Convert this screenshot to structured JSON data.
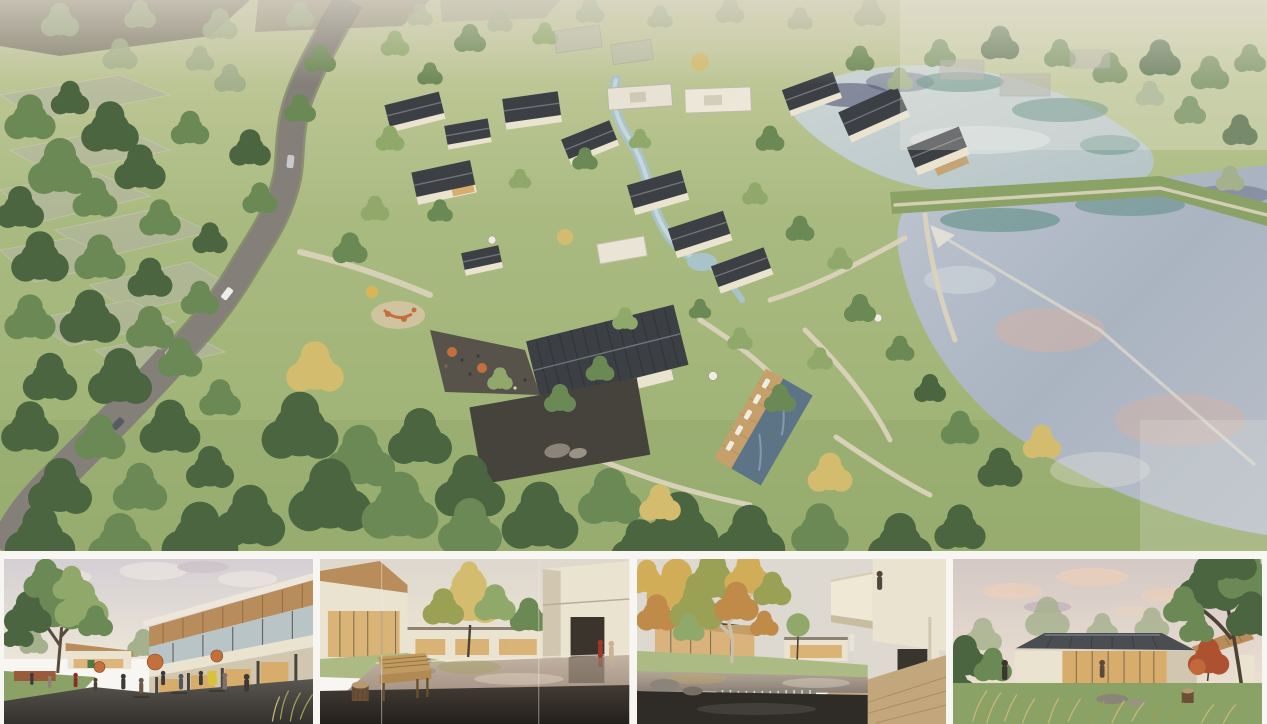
{
  "board": {
    "type": "architectural-rendering-presentation-board",
    "hero": {
      "label": "aerial-masterplan-render",
      "description": "Aerial rendering of a courtyard-house village resort: cream walls and dark pitched roofs clustered among meadows and mature trees, a curving grey access road with cars at left, terraced field plots, a winding stream, a swimming pool with timber deck and loungers, a playground and cafe terrace with orange umbrellas, and two large reflective ponds separated by a grass berm with a spillway at right."
    },
    "thumbnails": [
      {
        "label": "plaza-street-render",
        "description": "Eye-level view of a lively plaza street: two-storey buildings with slanted timber-lined roof canopies, terracotta cafe umbrellas and a small yellow shop sign, many people dining outdoors, a large green tree at left, dark paving foreground, soft pink-grey sky."
      },
      {
        "label": "courtyard-pond-render",
        "description": "Quiet courtyard with a shallow reflecting pond between cream buildings, a golden-green tree at its centre, a honey-wood bench and carved log stool on the dark stone deck in the foreground, and two figures in red and tan coats walking at right."
      },
      {
        "label": "waterfall-court-render",
        "description": "Garden court with a dark koi pond spilling over a stone weir, a pale-barked sycamore in autumn colour at left, low glass pavilions with warm light, and a cantilevered cream balcony volume with a standing figure at upper right above a stone terrace."
      },
      {
        "label": "garden-pavilion-render",
        "description": "Single-storey glass pavilion with a dark hipped standing-seam roof and warm interior light, a timber-soffit wing at right, a red maple and a large dark-green tree beside it, tall ornamental grasses and boulders on the lawn, peach evening clouds."
      }
    ]
  },
  "colors": {
    "paper": "#f7f6f2",
    "haze": "#d6d2c6",
    "meadow": "#abbb83",
    "meadowLight": "#c6cd9b",
    "meadowDark": "#8ba267",
    "forestDark": "#4a653f",
    "forestMid": "#6b8955",
    "forestLight": "#90a96a",
    "treeSage": "#a4b18c",
    "treeYellow": "#d3bc6d",
    "autumnGold": "#d2ad58",
    "autumnOrange": "#c08a48",
    "autumnOlive": "#9aa054",
    "soil": "#7b7569",
    "fieldPlot": "#b7b5aa",
    "road": "#847f78",
    "roadDark": "#6b675f",
    "roofDark": "#3c3f44",
    "roofLight": "#70747a",
    "wall": "#eae3d0",
    "wallShade": "#d1c7b0",
    "stone": "#a59a86",
    "courtyard": "#46433c",
    "water1": "#c8d2d3",
    "water2": "#aeb8c5",
    "waterTeal": "#4d8478",
    "reflNavy": "#4a4d6e",
    "reflPeach": "#d8b2a3",
    "pool": "#5d7486",
    "deck": "#c5a06b",
    "pathSand": "#dbd3bc",
    "accent": "#c4703d",
    "signYellow": "#d8c23a",
    "sky1": "#d8d2d4",
    "sky2": "#ece3d6",
    "cloudPeach": "#eacfba",
    "glassWarm": "#d8ad6c",
    "glassCool": "#b9c4c6",
    "woodSoffit": "#b88c5b",
    "benchWood": "#b08a54",
    "pavement": "#504c46",
    "pavementDark": "#33312d",
    "deckDark": "#2e2a25",
    "trunkPale": "#ccc0ab",
    "trunkDark": "#4e4234",
    "mapleRed": "#ad5130",
    "coatRed": "#a03828",
    "grassTan": "#c8b678",
    "pondWarm": "#a2948a",
    "pondDark": "#2f2c28",
    "weirStone": "#8c857a"
  }
}
